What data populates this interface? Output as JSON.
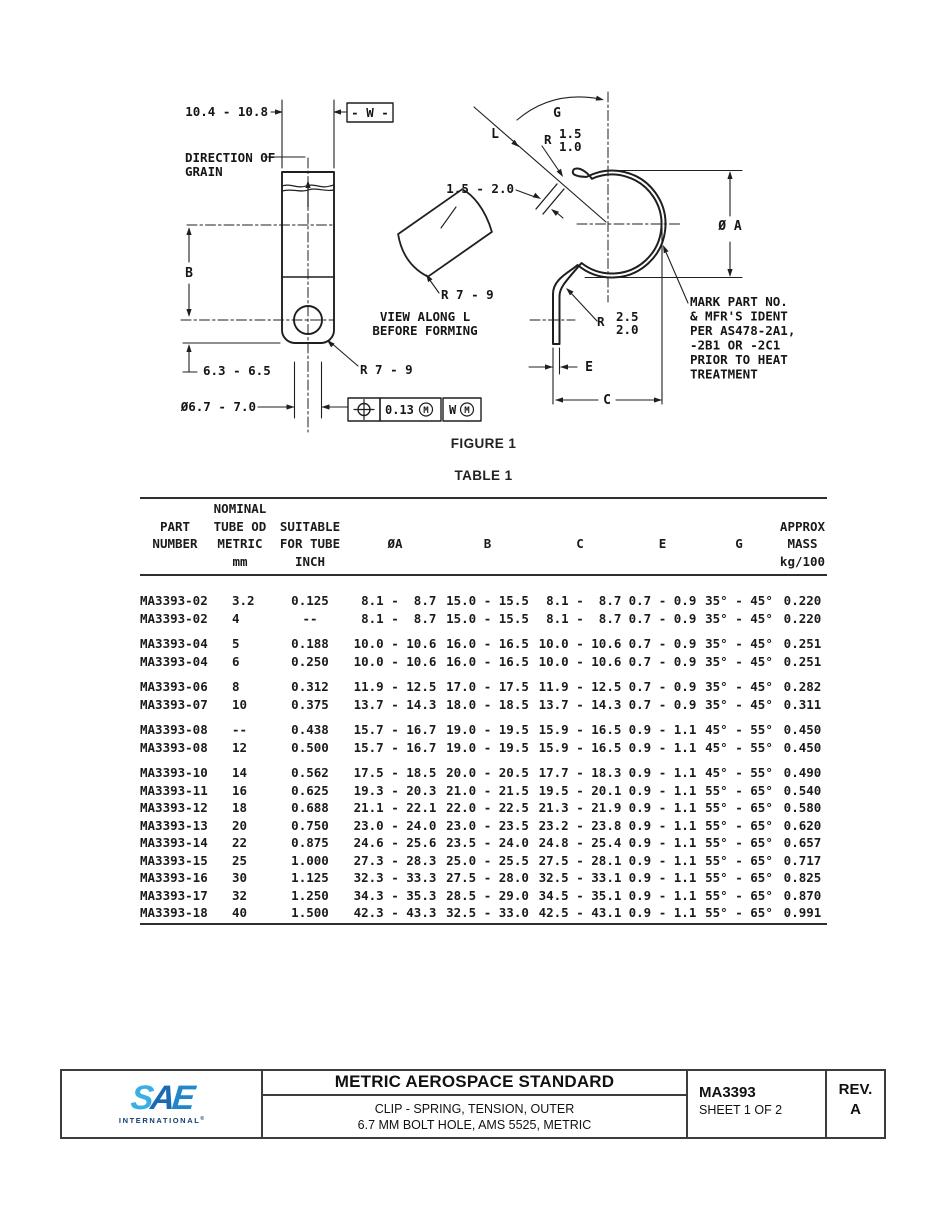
{
  "figure": {
    "caption": "FIGURE 1",
    "left_view": {
      "width_dim": "10.4 - 10.8",
      "datum_flag": "- W -",
      "grain_label_line1": "DIRECTION OF",
      "grain_label_line2": "GRAIN",
      "height_label": "B",
      "bottom_dim": "6.3 - 6.5",
      "hole_dim": "Ø6.7 - 7.0",
      "corner_radius": "R 7 - 9",
      "fcf": {
        "tolerance": "0.13",
        "modifier": "M",
        "datum": "W"
      }
    },
    "tube_view": {
      "radius": "R 7 - 9",
      "caption_line1": "VIEW ALONG L",
      "caption_line2": "BEFORE FORMING",
      "thickness_dim": "1.5 - 2.0"
    },
    "formed_view": {
      "angle_label": "G",
      "view_direction_label": "L",
      "end_radius_prefix": "R",
      "end_radius_max": "1.5",
      "end_radius_min": "1.0",
      "diameter_label": "Ø A",
      "bend_radius_prefix": "R",
      "bend_radius_max": "2.5",
      "bend_radius_min": "2.0",
      "leg_thickness_label": "E",
      "width_label": "C",
      "mark_note_lines": [
        "MARK PART NO.",
        "& MFR'S IDENT",
        "PER AS478-2A1,",
        "-2B1 OR -2C1",
        "PRIOR TO HEAT",
        "TREATMENT"
      ]
    }
  },
  "table": {
    "caption": "TABLE 1",
    "header_columns": [
      {
        "key": "part-number",
        "lines": [
          "",
          "PART",
          "NUMBER",
          ""
        ]
      },
      {
        "key": "tube-od-metric",
        "lines": [
          "NOMINAL",
          "TUBE OD",
          "METRIC",
          "mm"
        ]
      },
      {
        "key": "tube-inch",
        "lines": [
          "",
          "SUITABLE",
          "FOR TUBE",
          "INCH"
        ]
      },
      {
        "key": "dia-a",
        "lines": [
          "",
          "",
          "ØA",
          ""
        ]
      },
      {
        "key": "b",
        "lines": [
          "",
          "",
          "B",
          ""
        ]
      },
      {
        "key": "c",
        "lines": [
          "",
          "",
          "C",
          ""
        ]
      },
      {
        "key": "e",
        "lines": [
          "",
          "",
          "E",
          ""
        ]
      },
      {
        "key": "g",
        "lines": [
          "",
          "",
          "G",
          ""
        ]
      },
      {
        "key": "mass",
        "lines": [
          "",
          "APPROX",
          "MASS",
          "kg/100"
        ]
      }
    ],
    "rows": [
      {
        "gap_before": false,
        "cells": [
          "MA3393-02",
          "3.2",
          "0.125",
          " 8.1 -  8.7",
          "15.0 - 15.5",
          " 8.1 -  8.7",
          "0.7 - 0.9",
          "35° - 45°",
          "0.220"
        ]
      },
      {
        "gap_before": false,
        "cells": [
          "MA3393-02",
          "4",
          "--",
          " 8.1 -  8.7",
          "15.0 - 15.5",
          " 8.1 -  8.7",
          "0.7 - 0.9",
          "35° - 45°",
          "0.220"
        ]
      },
      {
        "gap_before": true,
        "cells": [
          "MA3393-04",
          "5",
          "0.188",
          "10.0 - 10.6",
          "16.0 - 16.5",
          "10.0 - 10.6",
          "0.7 - 0.9",
          "35° - 45°",
          "0.251"
        ]
      },
      {
        "gap_before": false,
        "cells": [
          "MA3393-04",
          "6",
          "0.250",
          "10.0 - 10.6",
          "16.0 - 16.5",
          "10.0 - 10.6",
          "0.7 - 0.9",
          "35° - 45°",
          "0.251"
        ]
      },
      {
        "gap_before": true,
        "cells": [
          "MA3393-06",
          "8",
          "0.312",
          "11.9 - 12.5",
          "17.0 - 17.5",
          "11.9 - 12.5",
          "0.7 - 0.9",
          "35° - 45°",
          "0.282"
        ]
      },
      {
        "gap_before": false,
        "cells": [
          "MA3393-07",
          "10",
          "0.375",
          "13.7 - 14.3",
          "18.0 - 18.5",
          "13.7 - 14.3",
          "0.7 - 0.9",
          "35° - 45°",
          "0.311"
        ]
      },
      {
        "gap_before": true,
        "cells": [
          "MA3393-08",
          "--",
          "0.438",
          "15.7 - 16.7",
          "19.0 - 19.5",
          "15.9 - 16.5",
          "0.9 - 1.1",
          "45° - 55°",
          "0.450"
        ]
      },
      {
        "gap_before": false,
        "cells": [
          "MA3393-08",
          "12",
          "0.500",
          "15.7 - 16.7",
          "19.0 - 19.5",
          "15.9 - 16.5",
          "0.9 - 1.1",
          "45° - 55°",
          "0.450"
        ]
      },
      {
        "gap_before": true,
        "cells": [
          "MA3393-10",
          "14",
          "0.562",
          "17.5 - 18.5",
          "20.0 - 20.5",
          "17.7 - 18.3",
          "0.9 - 1.1",
          "45° - 55°",
          "0.490"
        ]
      },
      {
        "gap_before": false,
        "cells": [
          "MA3393-11",
          "16",
          "0.625",
          "19.3 - 20.3",
          "21.0 - 21.5",
          "19.5 - 20.1",
          "0.9 - 1.1",
          "55° - 65°",
          "0.540"
        ]
      },
      {
        "gap_before": false,
        "cells": [
          "MA3393-12",
          "18",
          "0.688",
          "21.1 - 22.1",
          "22.0 - 22.5",
          "21.3 - 21.9",
          "0.9 - 1.1",
          "55° - 65°",
          "0.580"
        ]
      },
      {
        "gap_before": false,
        "cells": [
          "MA3393-13",
          "20",
          "0.750",
          "23.0 - 24.0",
          "23.0 - 23.5",
          "23.2 - 23.8",
          "0.9 - 1.1",
          "55° - 65°",
          "0.620"
        ]
      },
      {
        "gap_before": false,
        "cells": [
          "MA3393-14",
          "22",
          "0.875",
          "24.6 - 25.6",
          "23.5 - 24.0",
          "24.8 - 25.4",
          "0.9 - 1.1",
          "55° - 65°",
          "0.657"
        ]
      },
      {
        "gap_before": false,
        "cells": [
          "MA3393-15",
          "25",
          "1.000",
          "27.3 - 28.3",
          "25.0 - 25.5",
          "27.5 - 28.1",
          "0.9 - 1.1",
          "55° - 65°",
          "0.717"
        ]
      },
      {
        "gap_before": false,
        "cells": [
          "MA3393-16",
          "30",
          "1.125",
          "32.3 - 33.3",
          "27.5 - 28.0",
          "32.5 - 33.1",
          "0.9 - 1.1",
          "55° - 65°",
          "0.825"
        ]
      },
      {
        "gap_before": false,
        "cells": [
          "MA3393-17",
          "32",
          "1.250",
          "34.3 - 35.3",
          "28.5 - 29.0",
          "34.5 - 35.1",
          "0.9 - 1.1",
          "55° - 65°",
          "0.870"
        ]
      },
      {
        "gap_before": false,
        "cells": [
          "MA3393-18",
          "40",
          "1.500",
          "42.3 - 43.3",
          "32.5 - 33.0",
          "42.5 - 43.1",
          "0.9 - 1.1",
          "55° - 65°",
          "0.991"
        ]
      }
    ]
  },
  "footer": {
    "logo_letters": [
      "S",
      "A",
      "E"
    ],
    "logo_subtext": "INTERNATIONAL",
    "logo_reg": "®",
    "title": "METRIC AEROSPACE STANDARD",
    "subtitle_line1": "CLIP - SPRING, TENSION, OUTER",
    "subtitle_line2": "6.7 MM BOLT HOLE, AMS 5525, METRIC",
    "document_number": "MA3393",
    "sheet": "SHEET 1 OF 2",
    "rev_label": "REV.",
    "rev_value": "A"
  }
}
